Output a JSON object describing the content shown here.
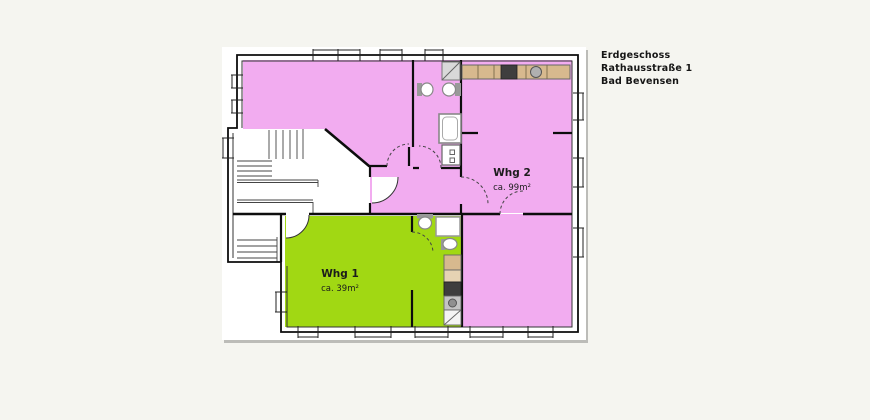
{
  "title_block": {
    "line1": "Erdgeschoss",
    "line2": "Rathausstraße 1",
    "line3": "Bad Bevensen"
  },
  "apartments": [
    {
      "id": "whg1",
      "label": "Whg 1",
      "area": "ca. 39m²",
      "color": "#a1d813"
    },
    {
      "id": "whg2",
      "label": "Whg 2",
      "area": "ca. 99m²",
      "color": "#f2acf0"
    }
  ],
  "colors": {
    "background": "#f5f5f0",
    "paper": "#ffffff",
    "wall": "#0d0d0d",
    "whg1_fill": "#a1d813",
    "whg2_fill": "#f2acf0",
    "counter": "#d7b98e",
    "counter_light": "#e6d3b3",
    "appliance_dark": "#3e3e3e",
    "fixture_gray": "#999999"
  }
}
